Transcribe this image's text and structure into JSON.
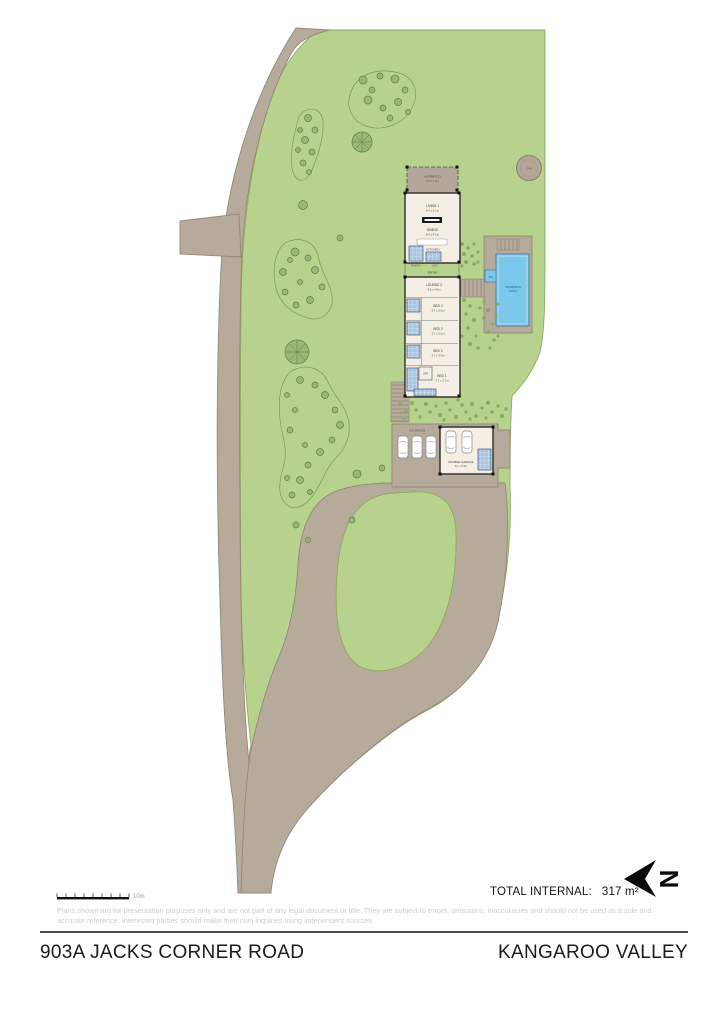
{
  "colors": {
    "lawn": "#b7d28c",
    "lawn_outline": "#8fa861",
    "driveway": "#b6aa9b",
    "driveway_outline": "#938878",
    "house_floor": "#f4eee5",
    "wall": "#2b2b2b",
    "wet_area_blue": "#a9c7e2",
    "pool_blue": "#7cc7ec",
    "pool_text_blue": "#1d64ad",
    "tree_fill": "#9ab875",
    "tree_outline": "#5f7f45",
    "label_gray": "#3d3d3d"
  },
  "plan": {
    "rooms": {
      "alfresco": {
        "name": "ALFRESCO",
        "dims": "8.4 x 3.4m"
      },
      "living": {
        "name": "LIVING 1",
        "dims": "8.4 x 5.1m"
      },
      "dining": {
        "name": "DINING",
        "dims": "8.4 x 4.1m"
      },
      "kitchen": {
        "name": "KITCHEN"
      },
      "pantry": {
        "name": "PANTRY"
      },
      "laundry": {
        "name": "LDRY"
      },
      "entry": {
        "name": "ENTRY"
      },
      "lounge2": {
        "name": "LOUNGE 2",
        "dims": "4.5 x 4.0m"
      },
      "bed4": {
        "name": "BED 4",
        "dims": "3.7 x 3.0m"
      },
      "bed3": {
        "name": "BED 3",
        "dims": "3.7 x 3.0m"
      },
      "bed2": {
        "name": "BED 2",
        "dims": "3.7 x 3.0m"
      },
      "bed1": {
        "name": "BED 1",
        "dims": "3.7 x 3.7m"
      },
      "wir": {
        "name": "WIR"
      },
      "garage": {
        "name": "DOUBLE GARAGE",
        "dims": "6.1 x 5.9m"
      },
      "car_spaces": {
        "name": "CAR SPACES"
      },
      "pool": {
        "line1": "SWIMMING",
        "line2": "POOL"
      },
      "spa": {
        "name": "SPA"
      },
      "tank": {
        "name": "TANK"
      }
    },
    "scale_label": "10m"
  },
  "footer": {
    "total_internal_label": "TOTAL INTERNAL:",
    "total_internal_value": "317 m²",
    "north_letter": "N",
    "disclaimer_line1": "Plans shown are for presentation purposes only and are not part of any legal document or title. They are subject to errors, omissions, inaccuracies and should not be used as a sole and",
    "disclaimer_line2": "accurate reference. Interested parties should make their own inquiries using independent sources.",
    "address": "903A JACKS CORNER ROAD",
    "locality": "KANGAROO VALLEY"
  }
}
